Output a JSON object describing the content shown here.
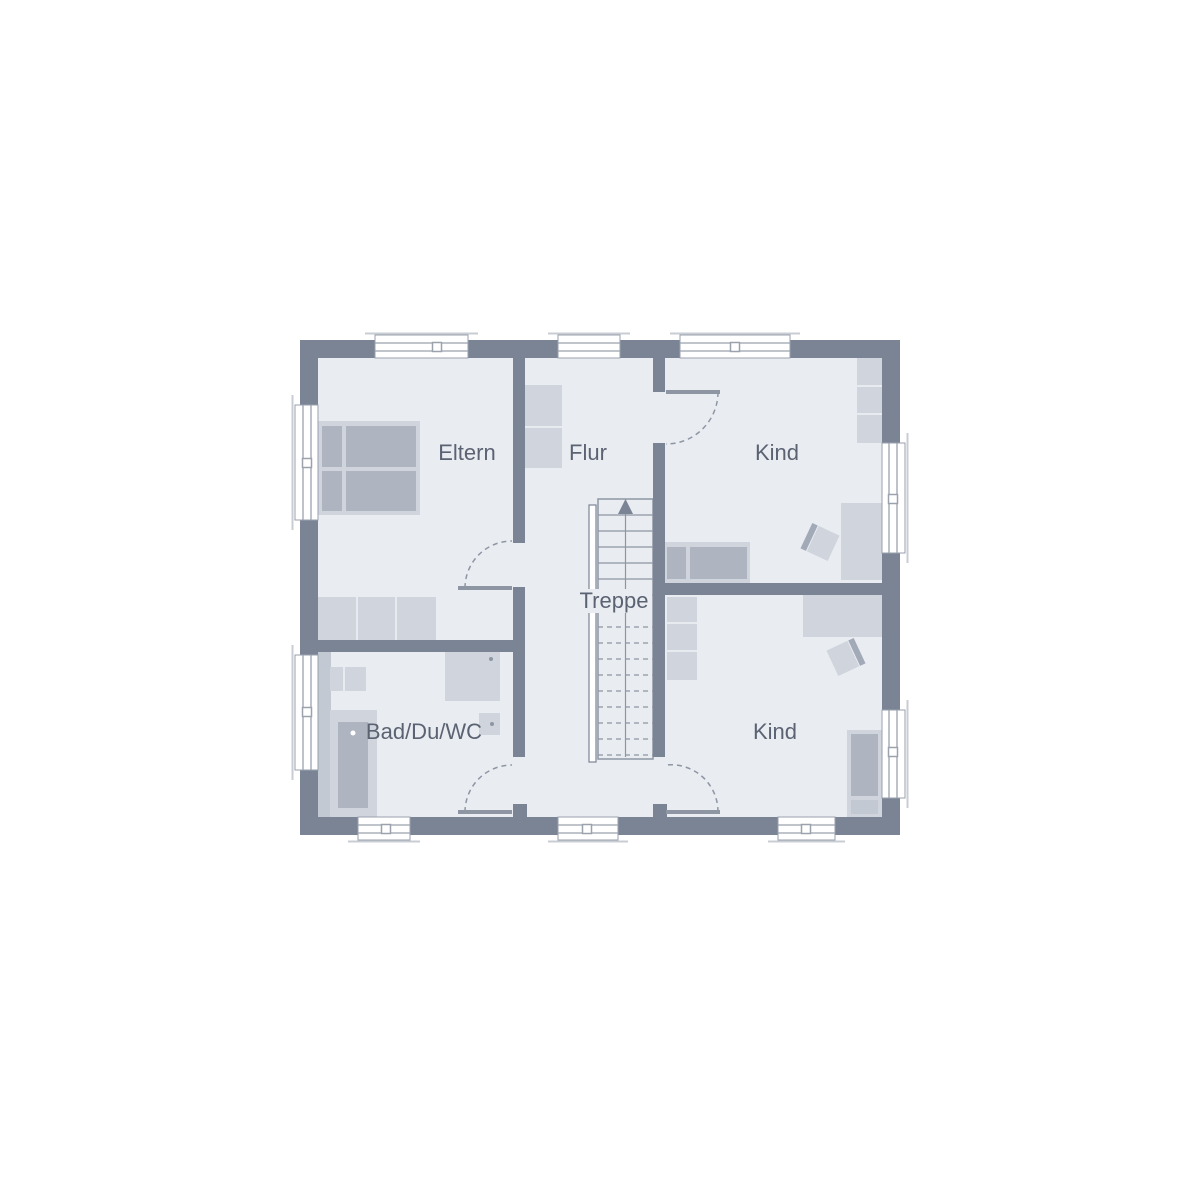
{
  "plan": {
    "title": "Obergeschoss Grundriss",
    "rooms": {
      "eltern": {
        "label": "Eltern"
      },
      "flur": {
        "label": "Flur"
      },
      "kind_top": {
        "label": "Kind"
      },
      "kind_bottom": {
        "label": "Kind"
      },
      "bad": {
        "label": "Bad/Du/WC"
      },
      "treppe": {
        "label": "Treppe"
      }
    },
    "furniture": {
      "eltern": [
        "double-bed-icon",
        "wardrobe-icon"
      ],
      "flur": [
        "cabinet-icon"
      ],
      "kind_top": [
        "bed-icon",
        "wardrobe-icon",
        "desk-icon",
        "chair-icon"
      ],
      "kind_bottom": [
        "bed-icon",
        "wardrobe-icon",
        "desk-icon",
        "chair-icon"
      ],
      "bad": [
        "bathtub-icon",
        "shower-icon",
        "toilet-icon",
        "washbasin-icon"
      ],
      "treppe": [
        "staircase-up-icon"
      ]
    },
    "counts": {
      "windows": 10,
      "doors": 4
    },
    "colors": {
      "background": "#ffffff",
      "wall": "#7b8494",
      "floor": "#e9ecf1",
      "furniture_light": "#cfd4dd",
      "furniture_dark": "#aeb5c1",
      "furniture_medium": "#c3c9d3",
      "outline": "#8e96a4",
      "window_frame": "#9aa2ae",
      "chair_back": "#a2aab8",
      "text": "#5b6373"
    }
  }
}
